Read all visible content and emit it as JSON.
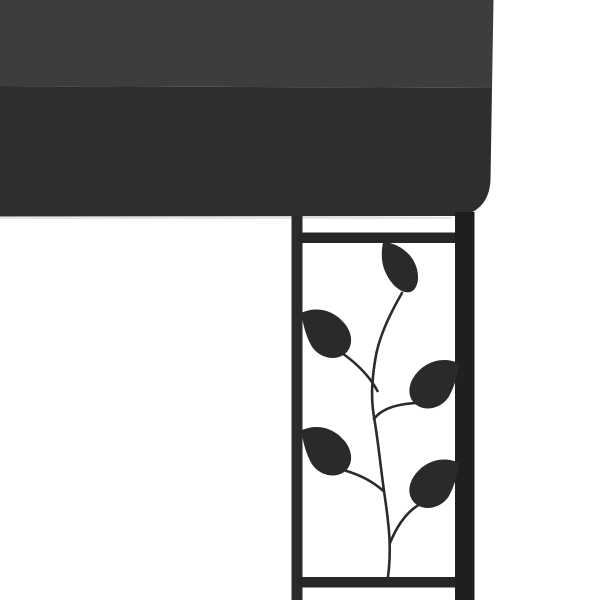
{
  "image": {
    "kind": "product-photo",
    "description": "Close-up of a wall gazebo corner: an anthracite fabric canopy roof over a black steel corner post joined to a decorative trellis panel with a curved vine stem and five teardrop leaf ornaments on a white background",
    "objects": {
      "canopy": "anthracite canopy with lighter top face and darker shaded front face",
      "post": "black steel corner post",
      "rail": "thin left trellis rail",
      "rungs": "top and bottom trellis crossbars",
      "vine": "curved wrought-iron vine stem with four side branches",
      "leaves": "five teardrop leaves (one hanging from top crossbar, two on left rail, two on right post)"
    },
    "leaf_count": "5"
  },
  "colors": {
    "background": "#ffffff",
    "canopy_top": "#3d3d3d",
    "canopy_shade": "#2e2e2e",
    "canopy_hem": "#d6d6d6",
    "post": "#1f1f1f",
    "rail": "#2a2a2a",
    "rung": "#262626",
    "vine": "#2b2b2b",
    "leaf": "#2a2a2a"
  }
}
